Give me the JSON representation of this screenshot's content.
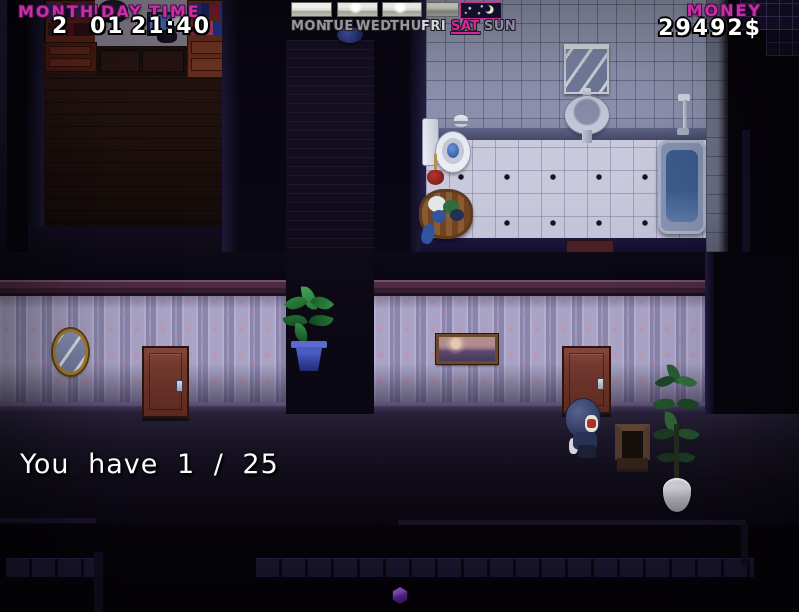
{
  "hud": {
    "calendar": {
      "month_label": "MONTH",
      "separator": "|",
      "day_label": "DAY",
      "time_label": "TIME",
      "month_value": "2",
      "day_value": "01",
      "time_value": "21:40"
    },
    "week": {
      "days": [
        {
          "label": "MON",
          "state": "normal"
        },
        {
          "label": "TUE",
          "state": "normal"
        },
        {
          "label": "WED",
          "state": "normal"
        },
        {
          "label": "THU",
          "state": "normal"
        },
        {
          "label": "FRI",
          "state": "bright"
        },
        {
          "label": "SAT",
          "state": "active"
        },
        {
          "label": "SUN",
          "state": "dim"
        }
      ],
      "weather_icons": [
        {
          "name": "cloudy-day-icon",
          "type": "day"
        },
        {
          "name": "sunny-day-icon",
          "type": "day-sun"
        },
        {
          "name": "sunny-day-icon",
          "type": "day-sun"
        },
        {
          "name": "overcast-day-icon",
          "type": "day-dim"
        },
        {
          "name": "night-moon-icon",
          "type": "night"
        }
      ]
    },
    "money": {
      "label": "MONEY",
      "value": "29492$"
    }
  },
  "message": {
    "text": "You have 1 / 25"
  },
  "palette": {
    "hud_accent": "#d02a9c",
    "hud_value_text": "#ffffff",
    "hud_muted": "#98989c",
    "active_day_border": "#c22a8e",
    "wallpaper": "#a9a3c6",
    "bathroom_floor": "#cdcee1",
    "door_wood": "#71382e",
    "gem": "#8a3cd0"
  }
}
